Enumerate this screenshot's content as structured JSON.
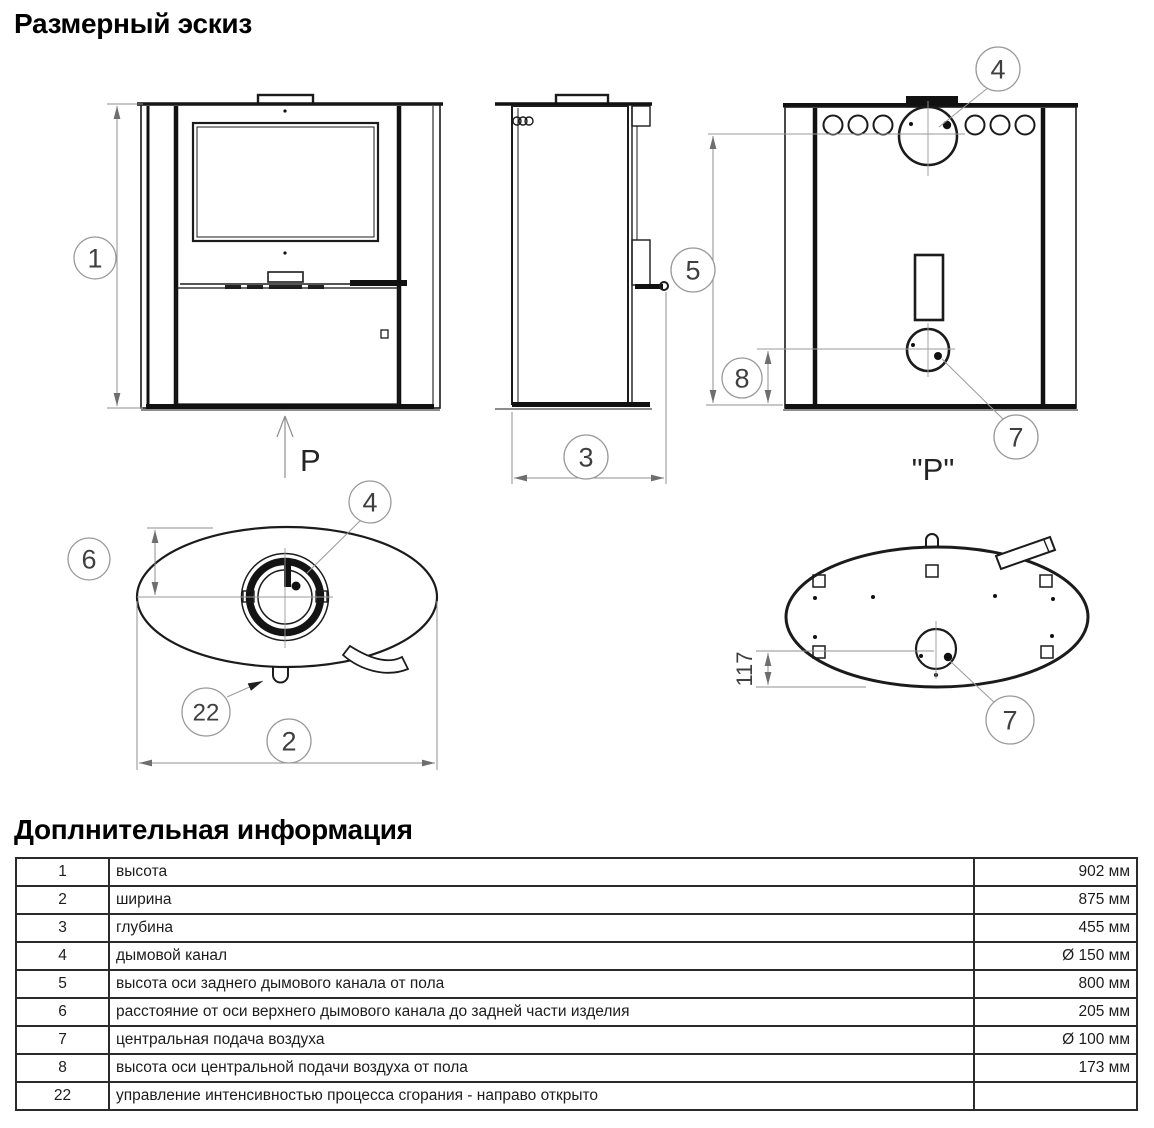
{
  "headings": {
    "dimensional_sketch": "Размерный эскиз",
    "additional_info": "Доплнительная информация"
  },
  "drawing": {
    "callouts": {
      "c1": "1",
      "c2": "2",
      "c3": "3",
      "c4": "4",
      "c5": "5",
      "c6": "6",
      "c7": "7",
      "c8": "8",
      "c22": "22"
    },
    "labels": {
      "front_arrow": "P",
      "rear_view_label": "\"P\"",
      "dim117": "117"
    }
  },
  "table": {
    "rows": [
      {
        "num": "1",
        "desc": "высота",
        "value": "902 мм"
      },
      {
        "num": "2",
        "desc": "ширина",
        "value": "875 мм"
      },
      {
        "num": "3",
        "desc": "глубина",
        "value": "455 мм"
      },
      {
        "num": "4",
        "desc": "дымовой канал",
        "value": "Ø 150 мм"
      },
      {
        "num": "5",
        "desc": "высота оси заднего дымового канала от пола",
        "value": "800 мм"
      },
      {
        "num": "6",
        "desc": "расстояние от оси верхнего дымового канала до задней части изделия",
        "value": "205 мм"
      },
      {
        "num": "7",
        "desc": "центральная подача воздуха",
        "value": "Ø 100 мм"
      },
      {
        "num": "8",
        "desc": "высота оси центральной подачи воздуха от пола",
        "value": "173 мм"
      },
      {
        "num": "22",
        "desc": "управление интенсивностью процесса сгорания - направо открыто",
        "value": ""
      }
    ]
  }
}
